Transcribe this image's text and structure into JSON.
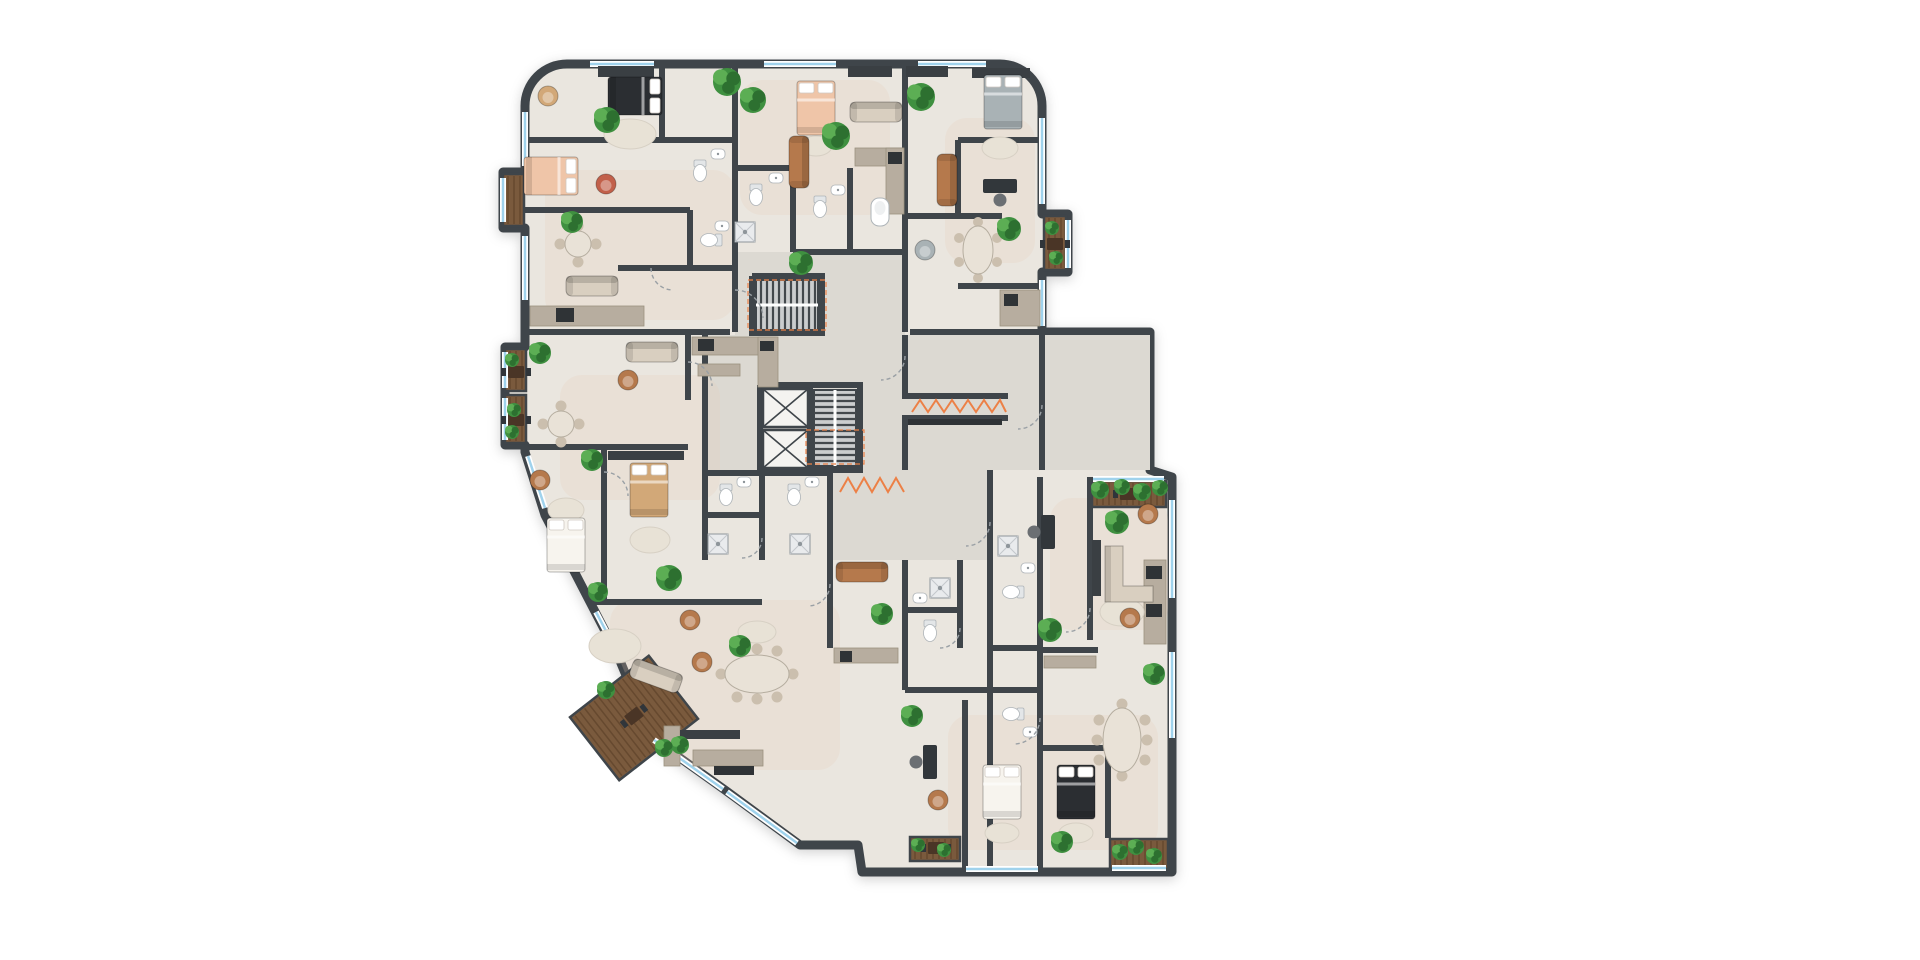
{
  "meta": {
    "description": "Color architectural floor plan of one residential level with seven apartments, central stair and elevator core, balconies and roof-deck terraces"
  },
  "palette": {
    "wall": "#3f454a",
    "floor": "#eae6df",
    "corridor": "#dcd9d2",
    "tint": "#e9cdb4",
    "deck": "#7a5a3d",
    "deckStripe": "#66492f",
    "glass": "#9fd2ec",
    "orange": "#ec8046",
    "stairBg": "#cbcdce",
    "tread": "#43484c",
    "counter": "#b7ad9f",
    "rug": "#e8e2d6",
    "plant": "#3f9040",
    "plantLight": "#5cae54",
    "plantDark": "#2d7030",
    "bedPeach": "#efc5a8",
    "bedWhite": "#f7f4ee",
    "bedDark": "#2b2e32",
    "bedGray": "#a9b2b5",
    "woodTan": "#d2a878",
    "sofaBrown": "#b5794c",
    "sofaBeige": "#d9cfc0",
    "rust": "#c2604a",
    "appliance": "#2f3336",
    "wardrobe": "#3a3f43"
  },
  "inventory": {
    "apartments": 7,
    "core": [
      "double-flight-staircase",
      "staircase",
      "elevator",
      "elevator",
      "service-niche"
    ],
    "rooms": [
      "bedrooms",
      "living-dining-areas",
      "kitchens",
      "bathrooms",
      "balconies",
      "terraces"
    ],
    "markings": [
      "orange-zigzag-thresholds",
      "orange-stair-outlines",
      "dashed-door-swings",
      "blue-window-glazing",
      "wood-deck-balconies",
      "potted-plants"
    ]
  },
  "plan": {
    "fp": "M572,64 L1000,64 A42,42 0 0 1 1042,106 L1042,214 L1068,214 L1068,272 L1042,272 L1042,332 L1150,332 L1150,470 L1172,477 L1172,872 L862,872 L858,845 L800,845 L725,790 L652,738 L618,656 L545,515 L525,452 L525,445 L505,445 L505,347 L525,347 L525,228 L503,228 L503,172 L525,172 L525,106 A42,42 0 0 1 567,64 Z",
    "halls": [
      "735,252 905,252 905,345 735,345",
      "705,335 1150,335 1150,470 705,470",
      "830,470 990,470 990,560 830,560"
    ],
    "warm": [
      [
        545,
        170,
        190,
        150
      ],
      [
        740,
        80,
        150,
        135
      ],
      [
        560,
        375,
        160,
        125
      ],
      [
        610,
        600,
        230,
        170
      ],
      [
        945,
        118,
        90,
        145
      ],
      [
        1050,
        498,
        118,
        132
      ],
      [
        948,
        715,
        210,
        135
      ]
    ],
    "decks": [
      [
        505,
        349,
        21,
        42,
        0
      ],
      [
        505,
        395,
        21,
        48,
        0
      ],
      [
        503,
        174,
        21,
        52,
        0
      ],
      [
        1044,
        216,
        22,
        54,
        0
      ],
      [
        1092,
        481,
        74,
        26,
        0
      ],
      [
        1110,
        839,
        58,
        30,
        0
      ],
      [
        910,
        837,
        50,
        24,
        0
      ],
      [
        584,
        678,
        100,
        80,
        -38
      ]
    ],
    "walls": [
      "735,64 735,332",
      "905,64 905,332",
      "525,332 730,332",
      "910,332 1042,332",
      "662,64 662,140",
      "525,140 735,140",
      "525,210 690,210",
      "690,210 690,268",
      "618,268 735,268",
      "793,168 793,252",
      "735,168 793,168",
      "793,252 905,252",
      "850,168 850,250",
      "958,140 1042,140",
      "958,140 958,216",
      "905,216 1002,216",
      "958,286 1042,286",
      "752,276 822,276 822,333 752,333 752,276",
      "705,335 705,560",
      "905,335 905,396",
      "905,418 905,470",
      "760,385 860,385 860,470 760,470 760,385",
      "810,385 810,470",
      "1042,335 1042,470",
      "990,470 990,868",
      "525,447 688,447",
      "688,335 688,400",
      "604,447 604,602",
      "589,602 762,602",
      "762,470 762,560",
      "830,470 830,560",
      "705,473 830,473",
      "705,515 762,515",
      "830,560 830,648",
      "905,560 905,690",
      "960,560 960,648",
      "905,610 960,610",
      "905,690 1040,690",
      "965,700 965,868",
      "1040,477 1040,868",
      "1090,477 1090,640",
      "1040,650 1098,650",
      "1042,748 1108,748",
      "1108,748 1108,838",
      "902,396 1008,396",
      "902,418 1008,418",
      "992,648 1040,648"
    ],
    "win": [
      [
        590,
        64,
        654,
        64
      ],
      [
        764,
        64,
        836,
        64
      ],
      [
        918,
        64,
        986,
        64
      ],
      [
        1042,
        118,
        1042,
        204
      ],
      [
        1068,
        220,
        1068,
        268
      ],
      [
        1042,
        280,
        1042,
        326
      ],
      [
        525,
        112,
        525,
        166
      ],
      [
        525,
        236,
        525,
        300
      ],
      [
        503,
        178,
        503,
        222
      ],
      [
        505,
        352,
        505,
        388
      ],
      [
        505,
        398,
        505,
        440
      ],
      [
        528,
        456,
        545,
        508
      ],
      [
        596,
        612,
        616,
        650
      ],
      [
        654,
        740,
        723,
        789
      ],
      [
        727,
        792,
        797,
        843
      ],
      [
        966,
        869,
        1038,
        869
      ],
      [
        1172,
        500,
        1172,
        598
      ],
      [
        1172,
        652,
        1172,
        738
      ],
      [
        1093,
        479,
        1164,
        479
      ],
      [
        1112,
        868,
        1166,
        868
      ]
    ],
    "zig": [
      "840,492 848,478 856,492 864,478 872,492 880,478 888,492 896,478 904,492",
      "912,412 920,400 928,412 936,400 944,412 952,400 960,412 968,400 976,412 984,400 992,412 1000,400 1006,412"
    ],
    "orect": [
      [
        748,
        280,
        78,
        50
      ],
      [
        806,
        430,
        58,
        34
      ]
    ],
    "stairs": [
      [
        756,
        280,
        62,
        50,
        "h"
      ],
      [
        814,
        390,
        42,
        76,
        "v"
      ]
    ],
    "lifts": [
      [
        763,
        389,
        45,
        38
      ],
      [
        763,
        430,
        45,
        38
      ]
    ],
    "counters": [
      [
        530,
        306,
        114,
        20
      ],
      [
        855,
        148,
        48,
        18
      ],
      [
        886,
        148,
        18,
        66
      ],
      [
        1000,
        290,
        40,
        36
      ],
      [
        692,
        337,
        84,
        18
      ],
      [
        758,
        337,
        20,
        50
      ],
      [
        698,
        364,
        42,
        12
      ],
      [
        693,
        750,
        70,
        16
      ],
      [
        664,
        726,
        16,
        40
      ],
      [
        834,
        648,
        64,
        15
      ],
      [
        1144,
        560,
        22,
        84
      ],
      [
        1044,
        656,
        52,
        12
      ]
    ],
    "appl": [
      [
        556,
        308,
        18,
        14
      ],
      [
        888,
        152,
        14,
        12
      ],
      [
        1004,
        294,
        14,
        12
      ],
      [
        698,
        339,
        16,
        12
      ],
      [
        760,
        341,
        14,
        10
      ],
      [
        714,
        766,
        40,
        9
      ],
      [
        840,
        651,
        12,
        11
      ],
      [
        1146,
        566,
        16,
        13
      ],
      [
        1146,
        604,
        16,
        13
      ],
      [
        908,
        419,
        94,
        6
      ]
    ],
    "darkr": [
      [
        598,
        66,
        56,
        11
      ],
      [
        906,
        66,
        42,
        11
      ],
      [
        972,
        68,
        58,
        10
      ],
      [
        608,
        451,
        76,
        9
      ],
      [
        680,
        730,
        60,
        9
      ],
      [
        1092,
        540,
        9,
        56
      ],
      [
        848,
        66,
        44,
        11
      ]
    ],
    "rugs": [
      [
        630,
        134,
        26,
        15
      ],
      [
        1000,
        148,
        18,
        11
      ],
      [
        650,
        540,
        20,
        13
      ],
      [
        566,
        510,
        18,
        12
      ],
      [
        615,
        646,
        26,
        17
      ],
      [
        1002,
        833,
        17,
        10
      ],
      [
        1076,
        833,
        17,
        10
      ],
      [
        1122,
        612,
        22,
        14
      ],
      [
        757,
        632,
        19,
        11
      ],
      [
        816,
        146,
        16,
        10
      ]
    ],
    "doors": [
      "M735,290 a28,28 0 0 1 28,28",
      "M905,356 a24,24 0 0 1 -24,24",
      "M688,362 a24,24 0 0 1 24,24",
      "M604,472 a24,24 0 0 1 24,24",
      "M830,584 a22,22 0 0 1 -22,22",
      "M1040,718 a26,26 0 0 1 -26,26",
      "M960,628 a20,20 0 0 1 -20,20",
      "M1090,608 a24,24 0 0 1 -24,24",
      "M762,538 a20,20 0 0 1 -20,20",
      "M990,522 a24,24 0 0 1 -24,24",
      "M651,268 a22,22 0 0 0 22,22",
      "M1042,405 a24,24 0 0 1 -24,24"
    ],
    "items": [
      [
        "bed",
        635,
        96,
        90,
        "dark"
      ],
      [
        "bed",
        551,
        176,
        90,
        "peach"
      ],
      [
        "bed",
        816,
        108,
        0,
        "peach"
      ],
      [
        "bed",
        1003,
        102,
        0,
        "gray"
      ],
      [
        "bed",
        649,
        490,
        0,
        "tan"
      ],
      [
        "bed",
        566,
        545,
        0,
        "white"
      ],
      [
        "bed",
        1002,
        792,
        0,
        "white"
      ],
      [
        "bed",
        1076,
        792,
        0,
        "dark"
      ],
      [
        "sofa",
        592,
        286,
        0,
        "beige"
      ],
      [
        "sofa",
        876,
        112,
        0,
        "beige"
      ],
      [
        "sofa",
        799,
        162,
        90,
        "brown"
      ],
      [
        "sofa",
        947,
        180,
        90,
        "brown"
      ],
      [
        "sofa",
        652,
        352,
        0,
        "beige"
      ],
      [
        "sofa",
        862,
        572,
        0,
        "brown"
      ],
      [
        "sofa",
        656,
        676,
        20,
        "beige"
      ],
      [
        "lsofa",
        1135,
        574,
        0,
        "beige"
      ],
      [
        "armchair",
        548,
        96,
        0,
        "tan"
      ],
      [
        "armchair",
        606,
        184,
        0,
        "rust"
      ],
      [
        "armchair",
        628,
        380,
        0,
        "brown"
      ],
      [
        "armchair",
        690,
        620,
        0,
        "brown"
      ],
      [
        "armchair",
        702,
        662,
        0,
        "brown"
      ],
      [
        "armchair",
        540,
        480,
        0,
        "brown"
      ],
      [
        "armchair",
        1130,
        618,
        0,
        "brown"
      ],
      [
        "armchair",
        1148,
        514,
        0,
        "brown"
      ],
      [
        "armchair",
        938,
        800,
        0,
        "brown"
      ],
      [
        "armchair",
        925,
        250,
        0,
        "gray"
      ],
      [
        "table4",
        578,
        244,
        0
      ],
      [
        "table4",
        561,
        424,
        0
      ],
      [
        "table6",
        978,
        250,
        90
      ],
      [
        "table8",
        757,
        674,
        0
      ],
      [
        "table8",
        1122,
        740,
        90
      ],
      [
        "desk",
        1000,
        186,
        0
      ],
      [
        "desk",
        1048,
        532,
        90
      ],
      [
        "desk",
        930,
        762,
        90
      ],
      [
        "decktable",
        516,
        372,
        0
      ],
      [
        "decktable",
        516,
        420,
        0
      ],
      [
        "decktable",
        1055,
        244,
        0
      ],
      [
        "decktable",
        1128,
        494,
        0
      ],
      [
        "decktable",
        936,
        848,
        0
      ],
      [
        "decktable",
        634,
        716,
        -38
      ],
      [
        "toilet",
        712,
        240,
        90
      ],
      [
        "sink",
        722,
        226,
        0
      ],
      [
        "toilet",
        700,
        170,
        0
      ],
      [
        "sink",
        718,
        154,
        0
      ],
      [
        "toilet",
        756,
        194,
        0
      ],
      [
        "sink",
        776,
        178,
        0
      ],
      [
        "shower",
        745,
        232,
        0
      ],
      [
        "toilet",
        820,
        206,
        0
      ],
      [
        "sink",
        838,
        190,
        0
      ],
      [
        "tub",
        880,
        212,
        0
      ],
      [
        "toilet",
        726,
        494,
        0
      ],
      [
        "sink",
        744,
        482,
        0
      ],
      [
        "shower",
        718,
        544,
        0
      ],
      [
        "toilet",
        794,
        494,
        0
      ],
      [
        "sink",
        812,
        482,
        0
      ],
      [
        "shower",
        800,
        544,
        0
      ],
      [
        "toilet",
        930,
        630,
        0
      ],
      [
        "sink",
        920,
        598,
        0
      ],
      [
        "shower",
        940,
        588,
        0
      ],
      [
        "toilet",
        1014,
        592,
        90
      ],
      [
        "sink",
        1028,
        568,
        0
      ],
      [
        "shower",
        1008,
        546,
        0
      ],
      [
        "toilet",
        1014,
        714,
        90
      ],
      [
        "sink",
        1030,
        732,
        0
      ]
    ],
    "plants": [
      [
        607,
        120,
        13
      ],
      [
        727,
        82,
        14
      ],
      [
        572,
        222,
        11
      ],
      [
        836,
        136,
        14
      ],
      [
        753,
        100,
        13
      ],
      [
        801,
        263,
        12
      ],
      [
        921,
        97,
        14
      ],
      [
        1009,
        229,
        12
      ],
      [
        540,
        353,
        11
      ],
      [
        592,
        460,
        11
      ],
      [
        598,
        592,
        10
      ],
      [
        669,
        578,
        13
      ],
      [
        740,
        646,
        11
      ],
      [
        882,
        614,
        11
      ],
      [
        1050,
        630,
        12
      ],
      [
        1117,
        522,
        12
      ],
      [
        1154,
        674,
        11
      ],
      [
        1062,
        842,
        11
      ],
      [
        912,
        716,
        11
      ],
      [
        680,
        745,
        9
      ],
      [
        1100,
        490,
        9
      ],
      [
        1122,
        487,
        8
      ],
      [
        1142,
        492,
        9
      ],
      [
        1160,
        488,
        8
      ],
      [
        1120,
        852,
        8
      ],
      [
        1136,
        847,
        8
      ],
      [
        1154,
        856,
        8
      ],
      [
        512,
        360,
        7
      ],
      [
        514,
        410,
        7
      ],
      [
        512,
        432,
        7
      ],
      [
        1052,
        228,
        7
      ],
      [
        1056,
        258,
        7
      ],
      [
        606,
        690,
        9
      ],
      [
        664,
        748,
        9
      ],
      [
        918,
        845,
        7
      ],
      [
        944,
        850,
        7
      ]
    ]
  }
}
